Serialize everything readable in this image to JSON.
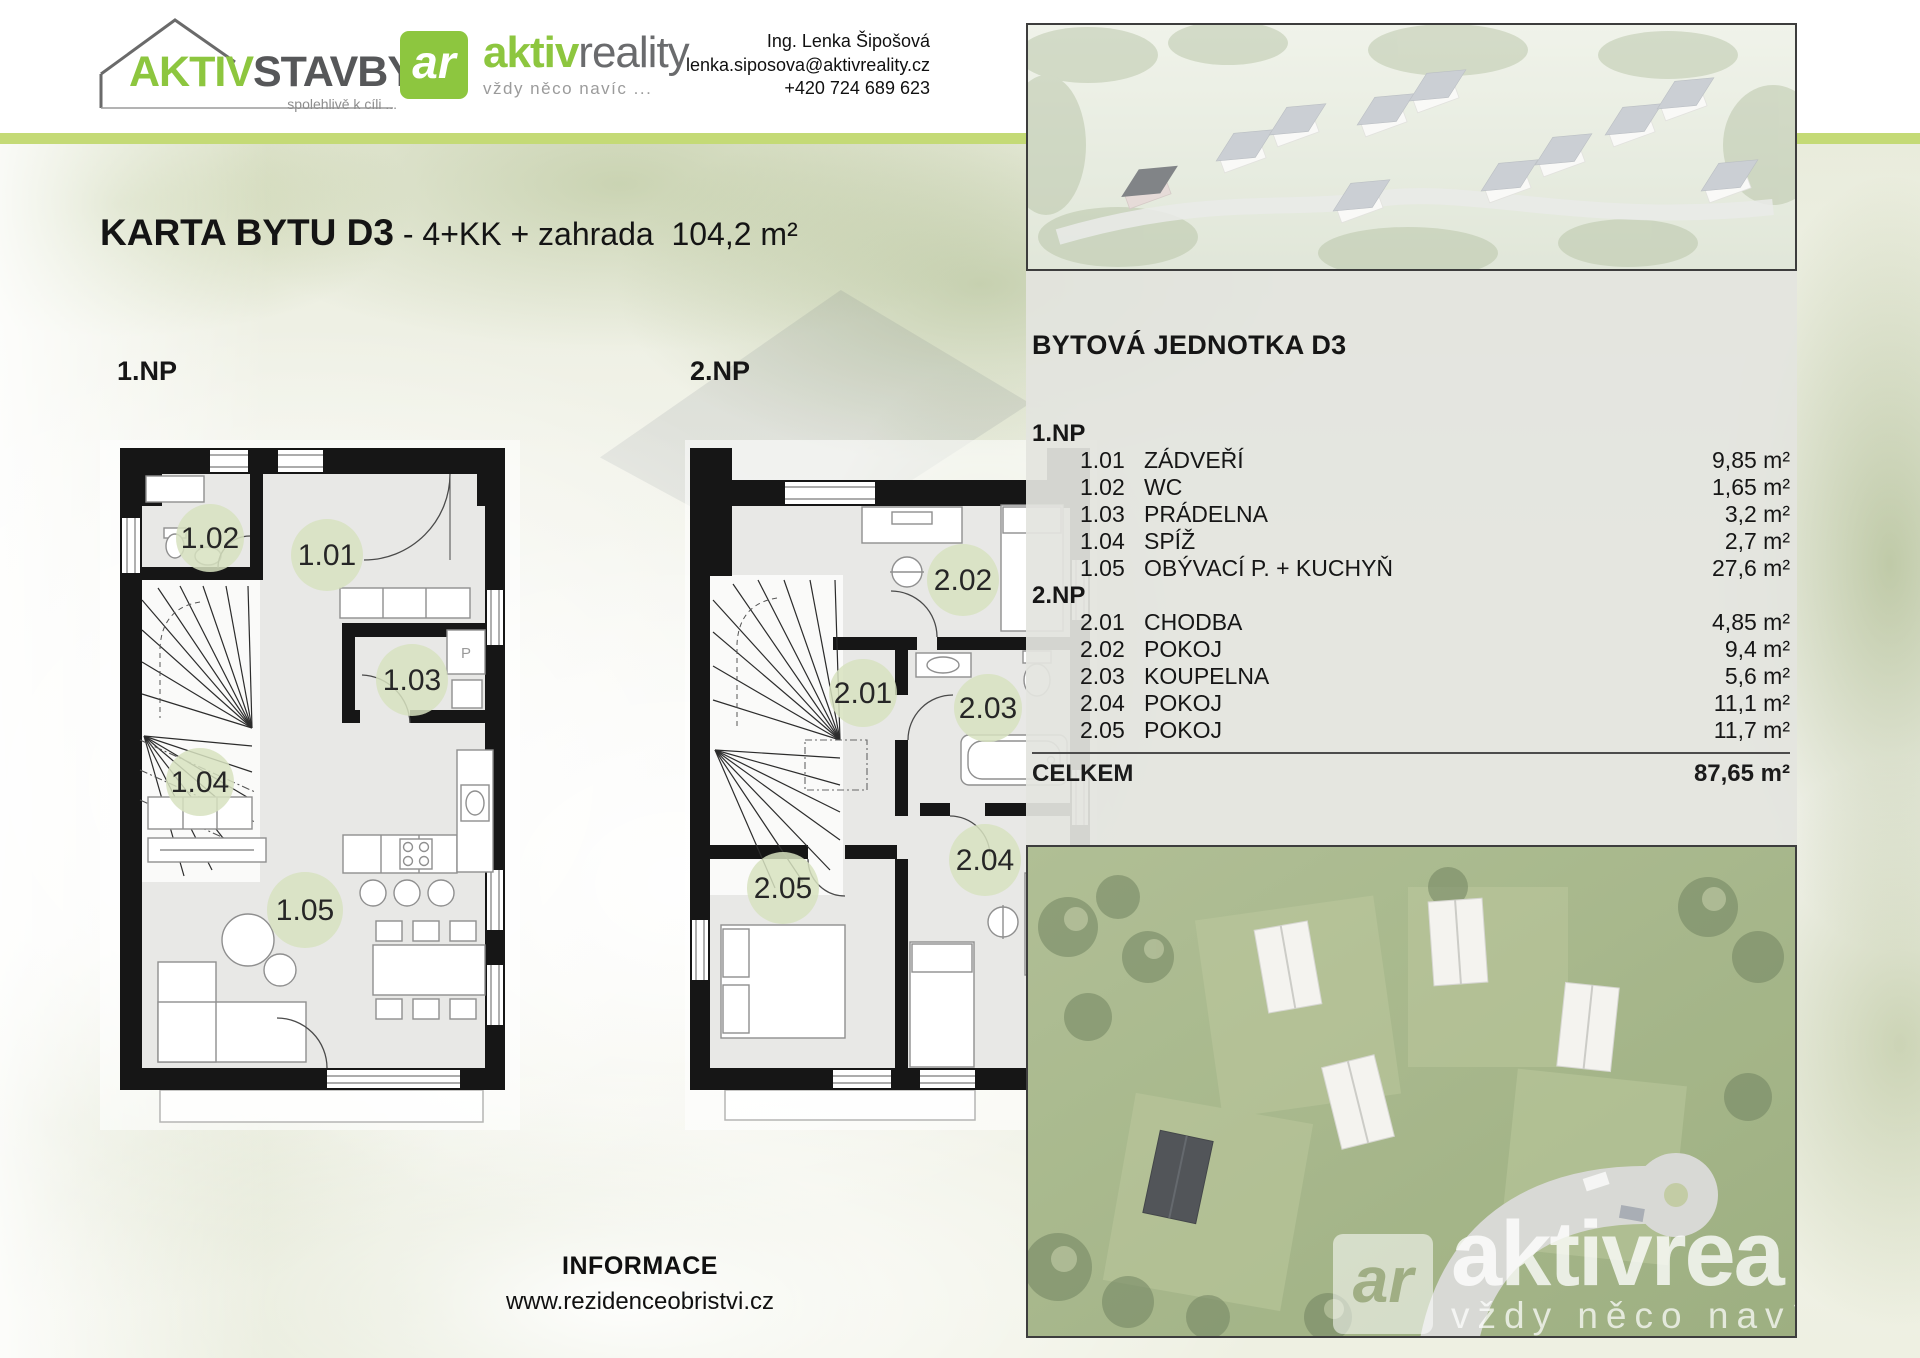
{
  "header": {
    "logo_stavby": {
      "brand_green": "AKTIV",
      "brand_gray": "STAVBY",
      "tagline": "spolehlivě k cíli ..."
    },
    "logo_reality": {
      "monogram": "ar",
      "brand_green": "aktiv",
      "brand_gray": "reality",
      "tagline": "vždy něco navíc ..."
    },
    "contact": {
      "name": "Ing. Lenka Šipošová",
      "email": "lenka.siposova@aktivreality.cz",
      "phone": "+420 724 689 623"
    }
  },
  "title": {
    "bold": "KARTA BYTU D3",
    "regular": " - 4+KK + zahrada  104,2 m²"
  },
  "floors": {
    "first_label": "1.NP",
    "second_label": "2.NP"
  },
  "plans": {
    "one": [
      "1.01",
      "1.02",
      "1.03",
      "1.04",
      "1.05"
    ],
    "two": [
      "2.01",
      "2.02",
      "2.03",
      "2.04",
      "2.05"
    ],
    "appliance_p": "P"
  },
  "unit_panel": {
    "heading": "BYTOVÁ JEDNOTKA D3",
    "sections": [
      {
        "label": "1.NP",
        "rows": [
          {
            "code": "1.01",
            "name": "ZÁDVEŘÍ",
            "area": "9,85 m²"
          },
          {
            "code": "1.02",
            "name": "WC",
            "area": "1,65 m²"
          },
          {
            "code": "1.03",
            "name": "PRÁDELNA",
            "area": "3,2 m²"
          },
          {
            "code": "1.04",
            "name": "SPÍŽ",
            "area": "2,7 m²"
          },
          {
            "code": "1.05",
            "name": "OBÝVACÍ P. + KUCHYŇ",
            "area": "27,6 m²"
          }
        ]
      },
      {
        "label": "2.NP",
        "rows": [
          {
            "code": "2.01",
            "name": "CHODBA",
            "area": "4,85 m²"
          },
          {
            "code": "2.02",
            "name": "POKOJ",
            "area": "9,4 m²"
          },
          {
            "code": "2.03",
            "name": "KOUPELNA",
            "area": "5,6 m²"
          },
          {
            "code": "2.04",
            "name": "POKOJ",
            "area": "11,1 m²"
          },
          {
            "code": "2.05",
            "name": "POKOJ",
            "area": "11,7 m²"
          }
        ]
      }
    ],
    "total_label": "CELKEM",
    "total_area": "87,65 m²"
  },
  "footer": {
    "info_label": "INFORMACE",
    "website": "www.rezidenceobristvi.cz"
  },
  "watermark": {
    "monogram": "ar",
    "brand": "aktivrea",
    "tagline": "vždy něco navíc ..."
  },
  "colors": {
    "accent_green": "#8dc63f",
    "stripe_green": "#c4da76",
    "label_circle": "#d7e2c0",
    "wall_black": "#161616",
    "room_gray": "#e8e8e6"
  }
}
